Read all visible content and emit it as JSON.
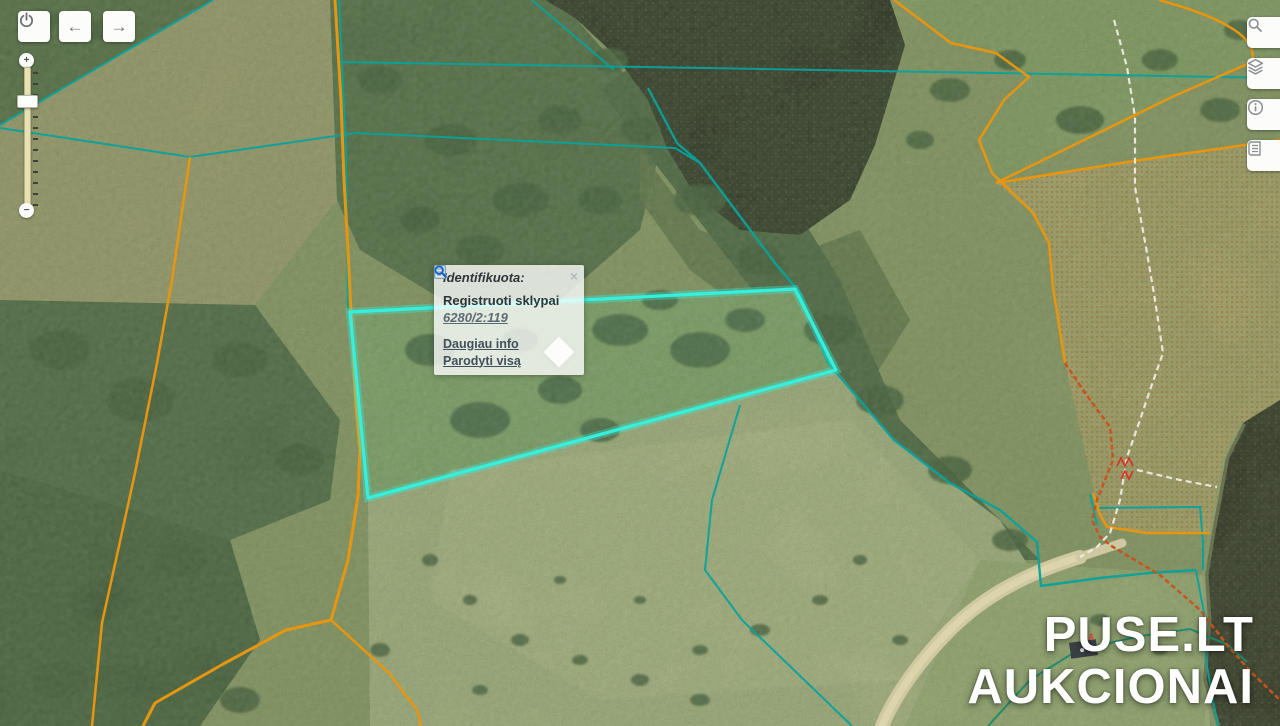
{
  "toolbar": {
    "power_icon": "power-icon",
    "back_icon": "←",
    "forward_icon": "→"
  },
  "zoom_slider": {
    "zoom_in_label": "+",
    "zoom_out_label": "−"
  },
  "right_toolbar": {
    "search_icon": "magnifier",
    "layers_icon": "layers",
    "info_icon": "info",
    "legend_icon": "legend-list"
  },
  "popup": {
    "title": "Identifikuota:",
    "close_label": "×",
    "layer_name": "Registruoti sklypai",
    "parcel_id": "6280/2:119",
    "links": [
      {
        "icon": "page-info-icon",
        "label": "Daugiau info"
      },
      {
        "icon": "magnifier-icon",
        "label": "Parodyti visą"
      }
    ]
  },
  "map_labels": {
    "building_label": "3A"
  },
  "watermark": {
    "line1": "PUSE.LT",
    "line2": "AUKCIONAI"
  },
  "colors": {
    "parcel_highlight": "#35f0dc",
    "cadastral_teal": "#0aa29b",
    "boundary_orange": "#e8960f",
    "boundary_red_dashed": "#c8541e",
    "label_red": "#d93025",
    "path_white": "#f1eee4"
  }
}
